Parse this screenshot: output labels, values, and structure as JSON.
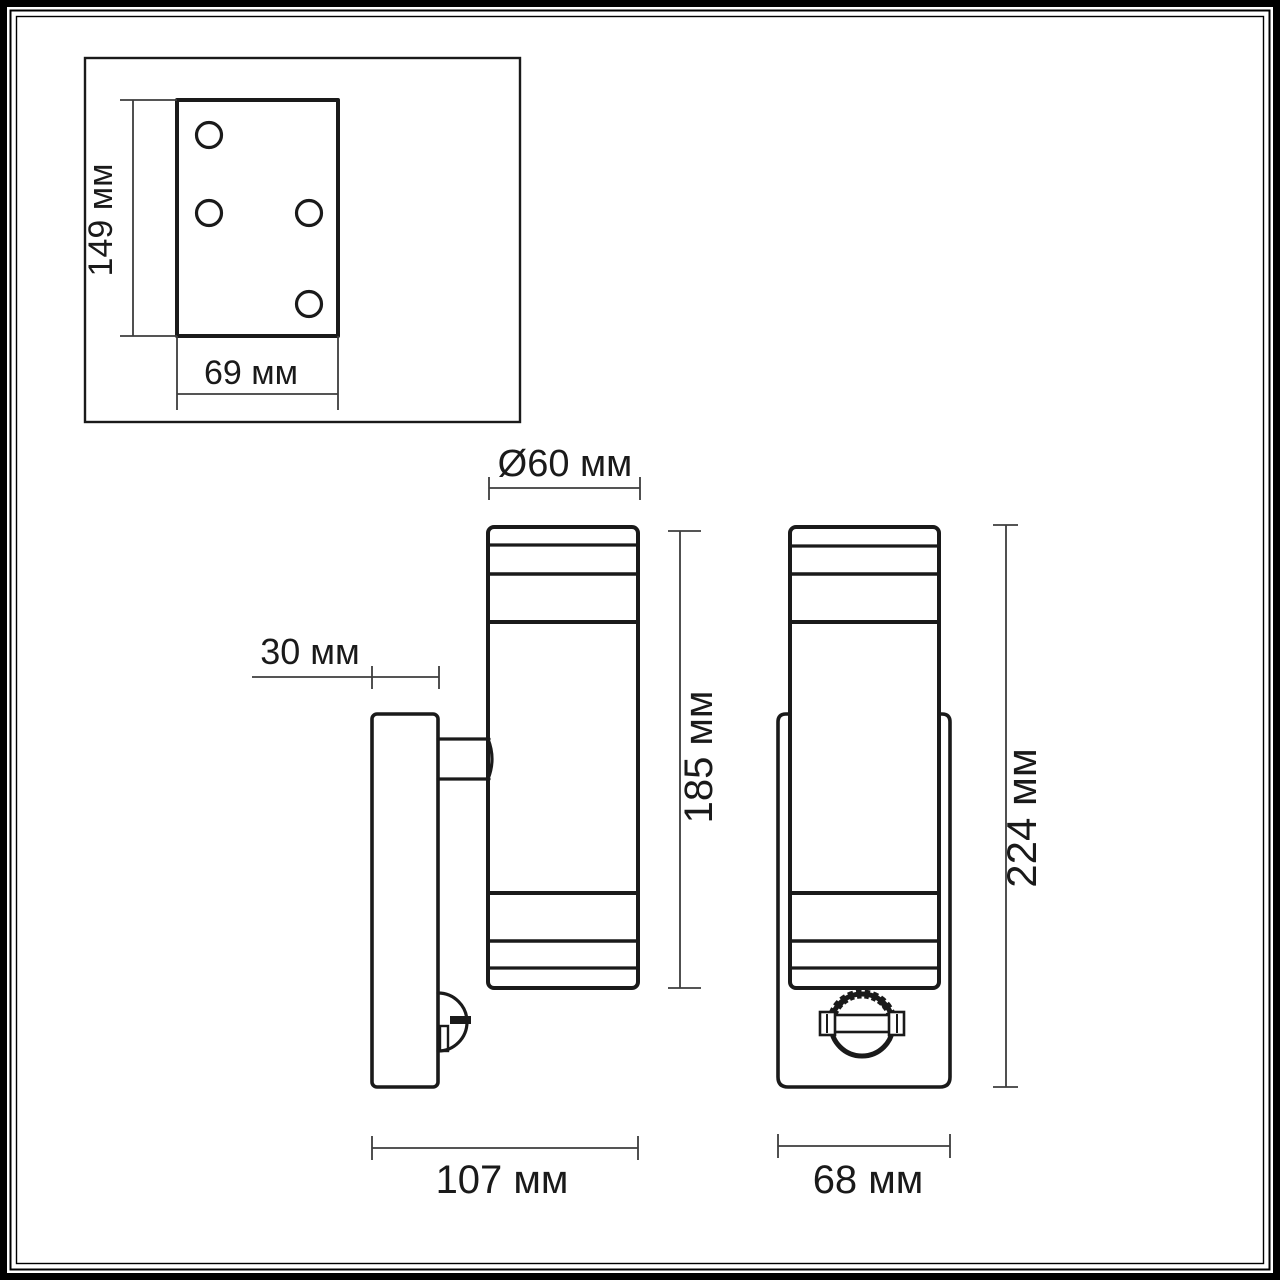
{
  "page": {
    "kind": "technical-dimension-drawing",
    "subject": "wall-lamp-with-motion-sensor",
    "units": "мм",
    "colors": {
      "background": "#ffffff",
      "object_line": "#1a1a1a",
      "dimension_line": "#3d3d3d",
      "text": "#1a1a1a"
    }
  },
  "inset": {
    "height_dim": "149 мм",
    "width_dim": "69 мм",
    "holes_count": 4
  },
  "side_view": {
    "plate_depth_dim": "30 мм",
    "diameter_dim": "Ø60 мм",
    "body_height_dim": "185 мм",
    "total_depth_dim": "107 мм"
  },
  "front_view": {
    "width_dim": "68 мм",
    "total_height_dim": "224 мм"
  }
}
